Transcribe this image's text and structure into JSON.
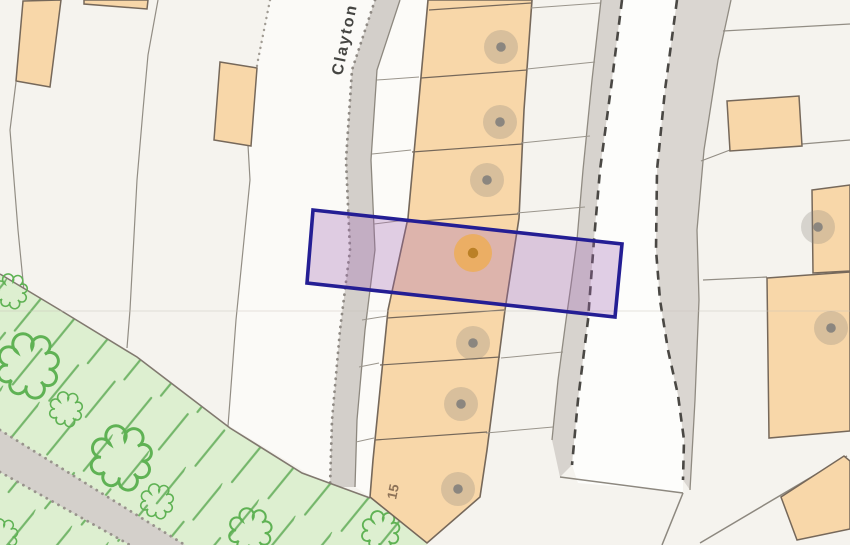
{
  "map": {
    "street_label": "Clayton",
    "plot_number_label": "15",
    "highlight": {
      "stroke_color": "#241e94",
      "fill_color": "rgba(158,100,180,0.30)",
      "marker_color": "#c08428",
      "marker_halo_color": "rgba(238,172,80,0.75)"
    },
    "marker_styles": {
      "gray_halo": "rgba(133,128,121,0.28)",
      "gray_dot": "#8b867f",
      "orange_halo": "rgba(238,172,80,0.78)",
      "orange_dot": "#bb8026"
    },
    "markers": [
      {
        "x": 501,
        "y": 47,
        "type": "gray"
      },
      {
        "x": 500,
        "y": 122,
        "type": "gray"
      },
      {
        "x": 487,
        "y": 180,
        "type": "gray"
      },
      {
        "x": 473,
        "y": 343,
        "type": "gray"
      },
      {
        "x": 461,
        "y": 404,
        "type": "gray"
      },
      {
        "x": 458,
        "y": 489,
        "type": "gray"
      },
      {
        "x": 818,
        "y": 227,
        "type": "gray"
      },
      {
        "x": 831,
        "y": 328,
        "type": "gray"
      },
      {
        "x": 473,
        "y": 253,
        "type": "orange"
      }
    ],
    "trees": [
      {
        "x": 13,
        "y": 293,
        "s": 1.0
      },
      {
        "x": 32,
        "y": 369,
        "s": 1.85
      },
      {
        "x": 68,
        "y": 411,
        "s": 1.0
      },
      {
        "x": 125,
        "y": 461,
        "s": 1.85
      },
      {
        "x": 159,
        "y": 503,
        "s": 1.0
      },
      {
        "x": 253,
        "y": 533,
        "s": 1.3
      },
      {
        "x": 383,
        "y": 533,
        "s": 1.15
      },
      {
        "x": 4,
        "y": 537,
        "s": 0.95
      }
    ],
    "colors": {
      "background_parcel": "#f5f3ee",
      "bright_parcel": "#fbfaf7",
      "road_fill": "#d3cfca",
      "right_road_fill": "#dad6d1",
      "verge_fill": "#d7d3ce",
      "lane_fill": "#fdfdfb",
      "building_fill": "#f8d7a9",
      "building_stroke": "#76685a",
      "green_fill": "#ddefd0",
      "green_symbol": "#74b66a",
      "boundary_line": "#8d887f",
      "dashed_path": "#4a4844"
    }
  }
}
